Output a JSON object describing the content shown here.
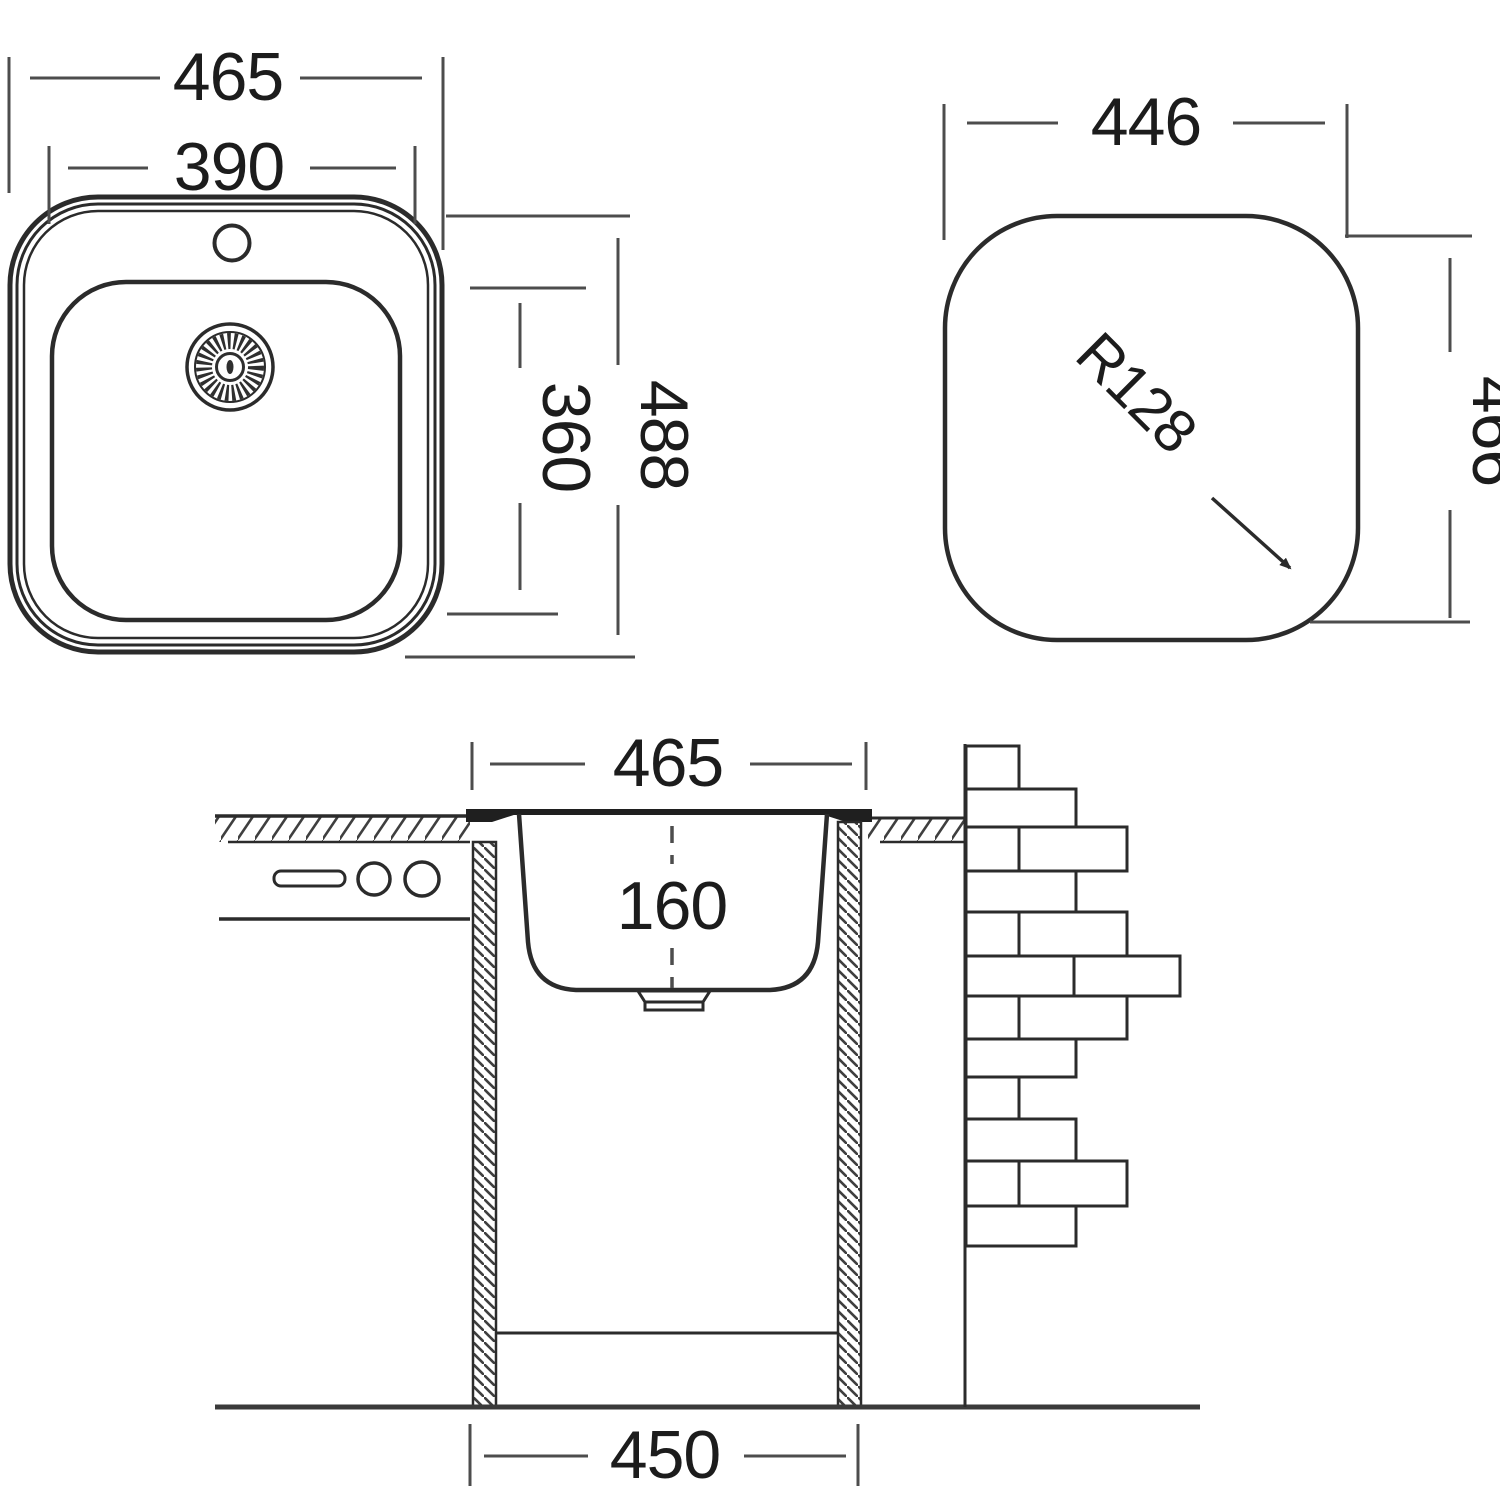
{
  "drawing": {
    "type": "technical-dimension-drawing",
    "subject": "kitchen sink installation diagram",
    "views": {
      "top_view": {
        "overall_width": "465",
        "bowl_width": "390",
        "overall_depth": "488",
        "bowl_depth": "360"
      },
      "cutout_view": {
        "cutout_width": "446",
        "cutout_height": "466",
        "corner_radius": "R128"
      },
      "section_view": {
        "rim_width": "465",
        "bowl_depth": "160",
        "cabinet_width": "450"
      }
    },
    "colors": {
      "background": "#ffffff",
      "object_line": "#2b2b2b",
      "dimension_line": "#4d4d4d",
      "text": "#1c1c1c"
    }
  }
}
